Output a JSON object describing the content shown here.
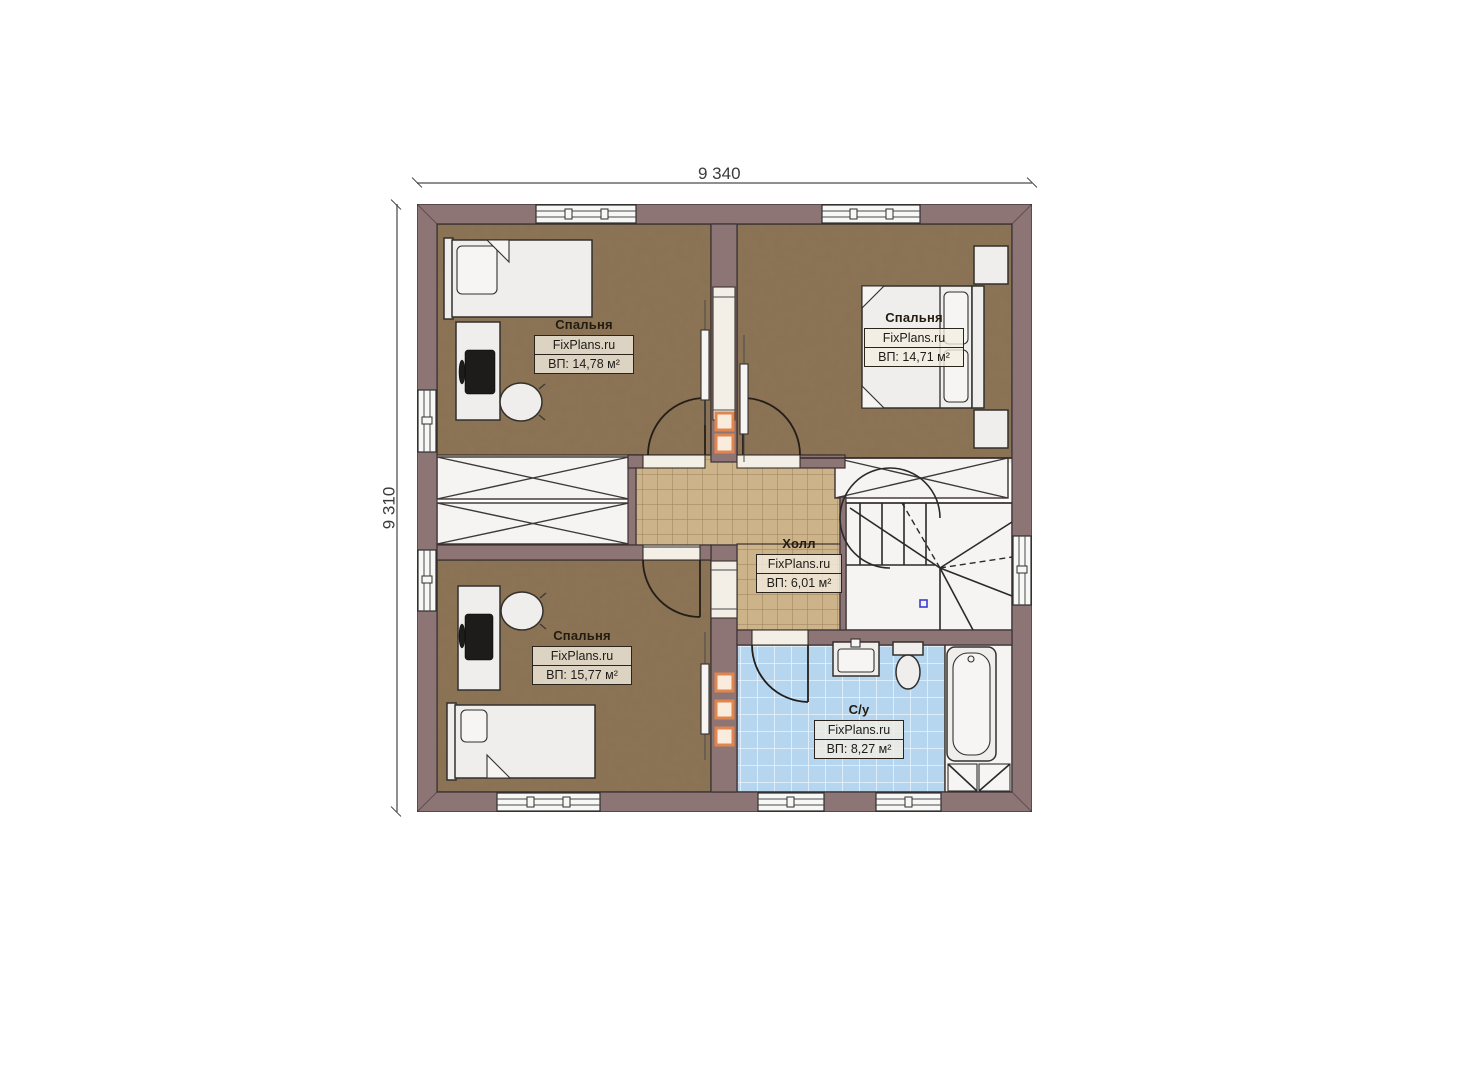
{
  "watermark": "FixPlans.ru",
  "dimensions": {
    "top": "9 340",
    "left": "9 310"
  },
  "rooms": [
    {
      "name": "Спальня",
      "area": "ВП: 14,78 м²"
    },
    {
      "name": "Спальня",
      "area": "ВП: 14,71 м²"
    },
    {
      "name": "Холл",
      "area": "ВП: 6,01 м²"
    },
    {
      "name": "Спальня",
      "area": "ВП: 15,77 м²"
    },
    {
      "name": "С/у",
      "area": "ВП: 8,27 м²"
    }
  ],
  "colors": {
    "wall": "#8d7576",
    "bedroom_floor": "#8d7456",
    "hall_tile": "#cdb38a",
    "hall_tile_line": "#9a7f5c",
    "bath_tile": "#b6d6f0",
    "bath_tile_line": "#e9f3fc",
    "white_floor": "#f5f4f2",
    "accent_orange": "#e0854e"
  }
}
